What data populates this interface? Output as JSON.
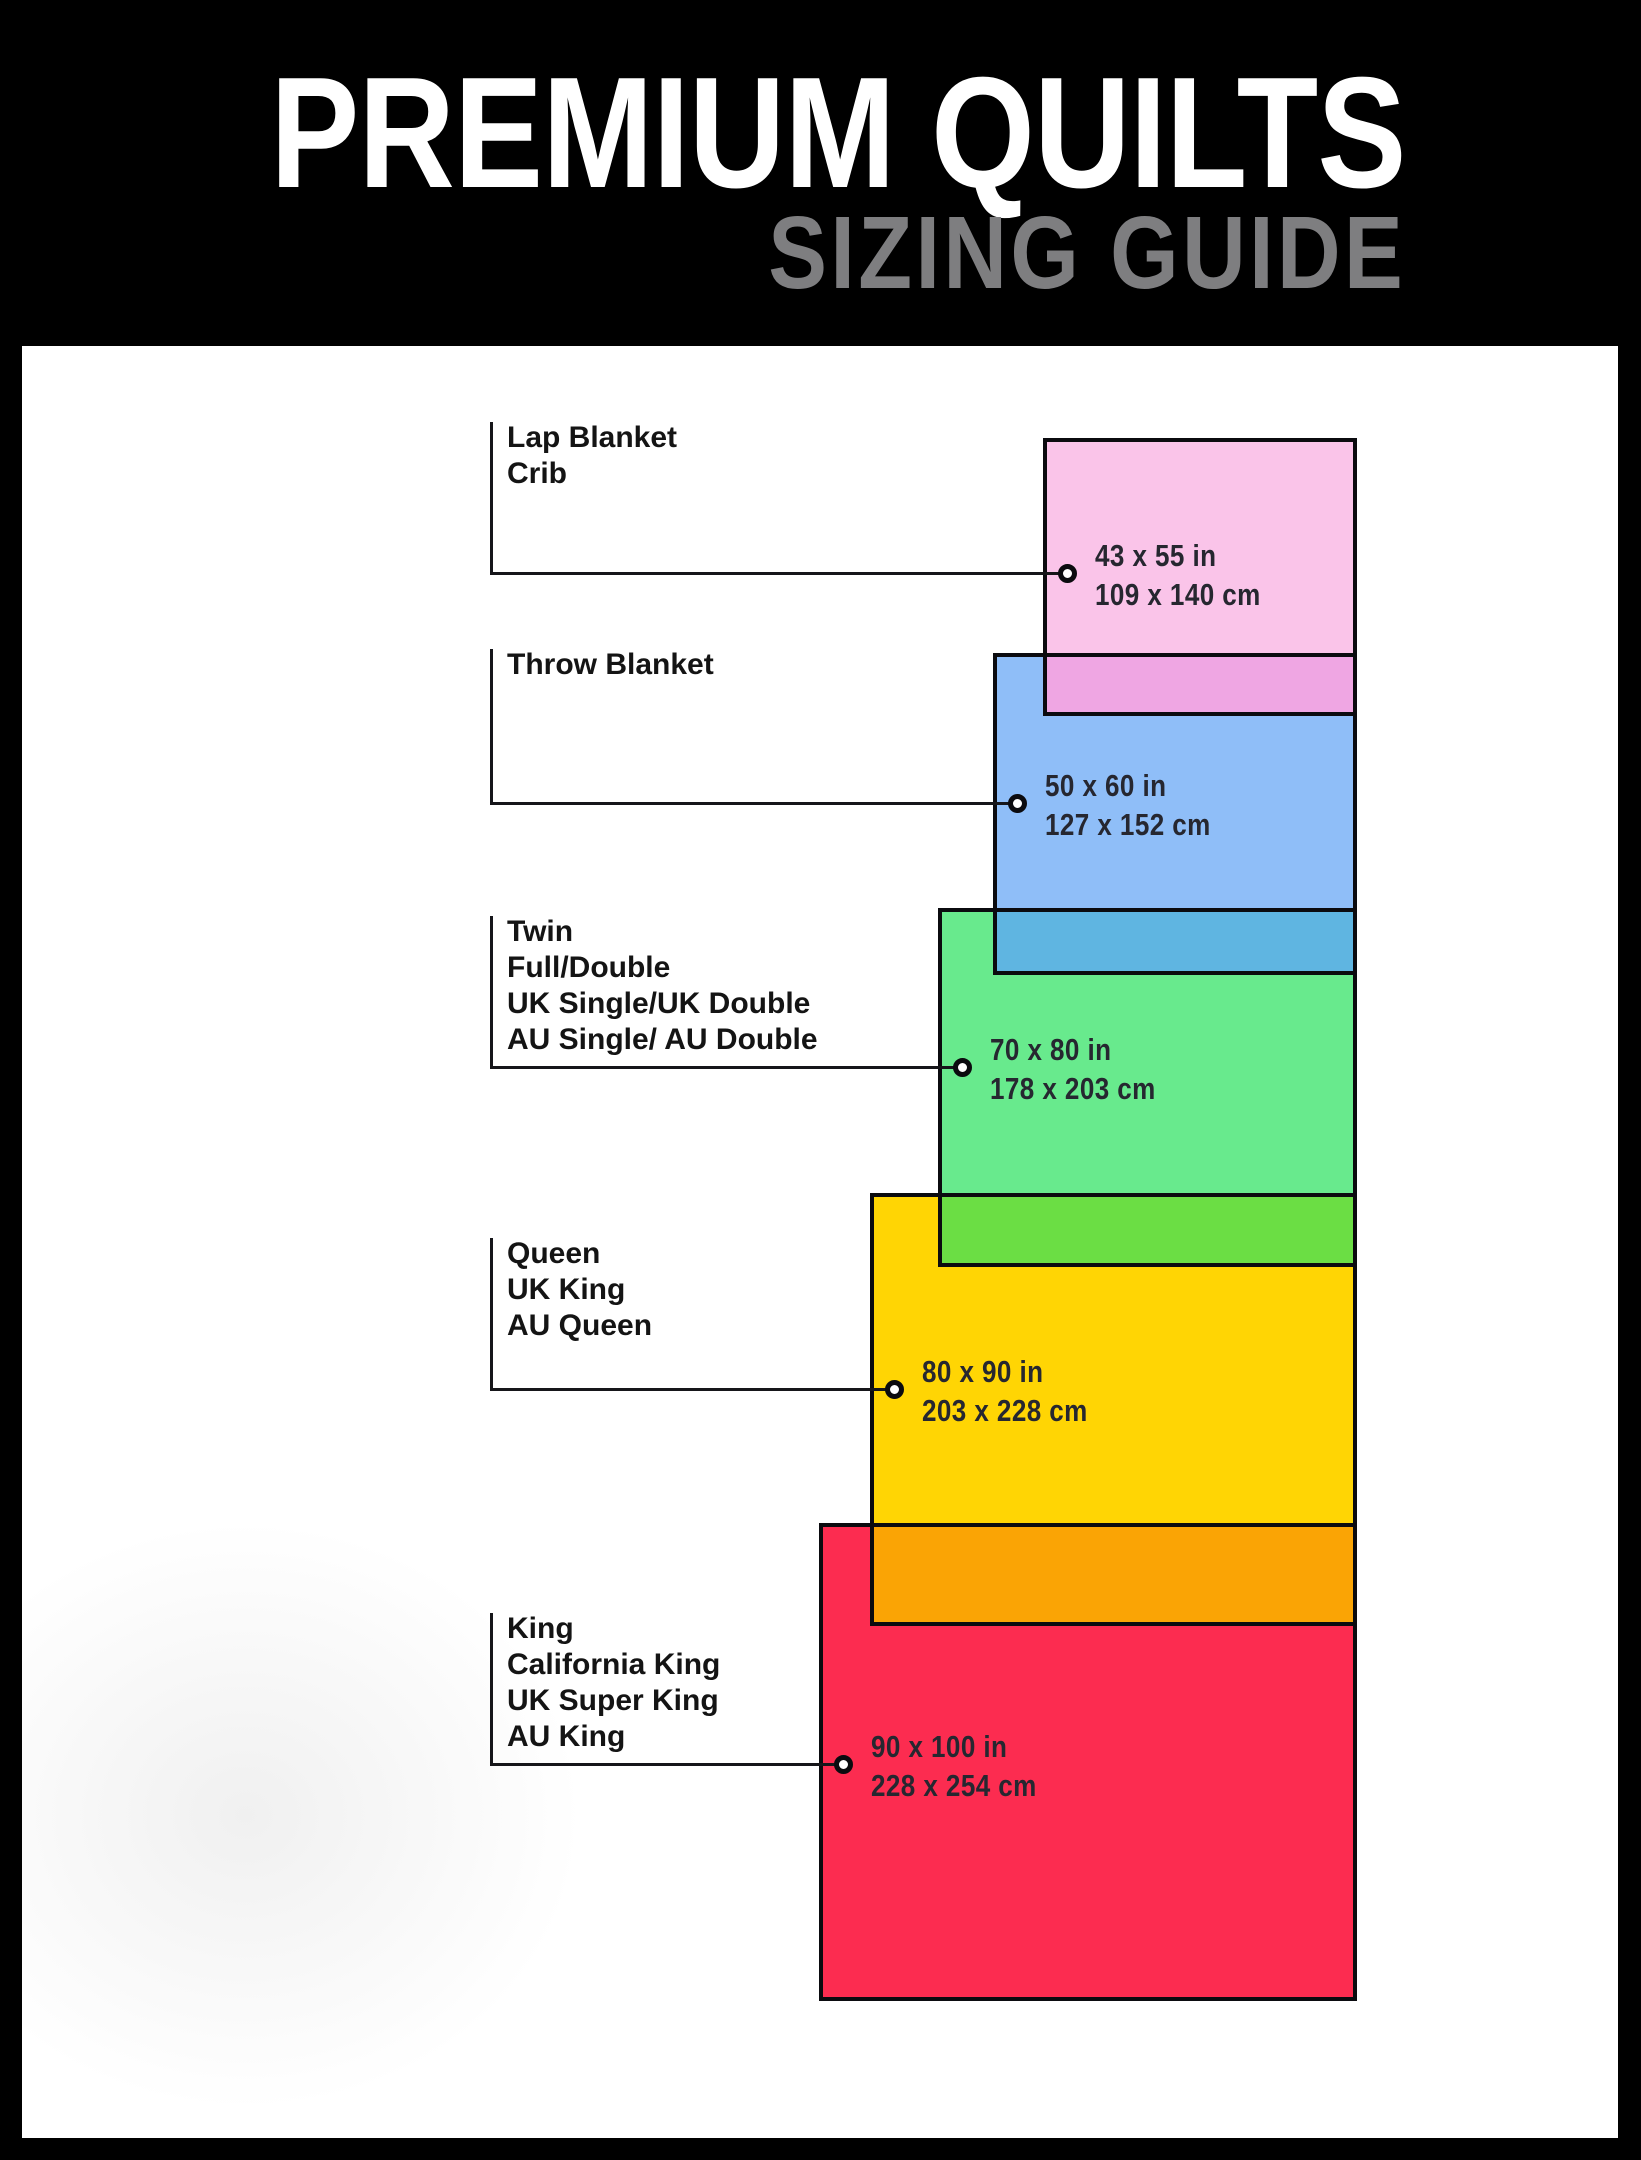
{
  "header": {
    "title": "PREMIUM QUILTS",
    "subtitle": "SIZING GUIDE",
    "bg_color": "#000000",
    "title_color": "#ffffff",
    "subtitle_color": "#7e7e80"
  },
  "panel": {
    "bg_color": "#ffffff",
    "outline_color": "#0b0b0f"
  },
  "sizes": [
    {
      "id": "lap",
      "labels": [
        "Lap Blanket",
        "Crib"
      ],
      "size_in": "43 x 55 in",
      "size_cm": "109 x 140 cm",
      "fill": "#FAC4E9",
      "overlap_fill": null
    },
    {
      "id": "throw",
      "labels": [
        "Throw Blanket"
      ],
      "size_in": "50 x 60 in",
      "size_cm": "127 x 152 cm",
      "fill": "#8FBEF8",
      "overlap_fill": "#EFA6E3"
    },
    {
      "id": "twin",
      "labels": [
        "Twin",
        "Full/Double",
        "UK Single/UK Double",
        "AU Single/ AU Double"
      ],
      "size_in": "70 x 80 in",
      "size_cm": "178 x 203 cm",
      "fill": "#68EA8D",
      "overlap_fill": "#5FB5E1"
    },
    {
      "id": "queen",
      "labels": [
        "Queen",
        "UK King",
        "AU Queen"
      ],
      "size_in": "80 x 90 in",
      "size_cm": "203 x 228 cm",
      "fill": "#FFD504",
      "overlap_fill": "#6BDE44"
    },
    {
      "id": "king",
      "labels": [
        "King",
        "California King",
        "UK Super King",
        "AU King"
      ],
      "size_in": "90 x 100 in",
      "size_cm": "228 x 254 cm",
      "fill": "#FC2C50",
      "overlap_fill": "#FAA405"
    }
  ]
}
